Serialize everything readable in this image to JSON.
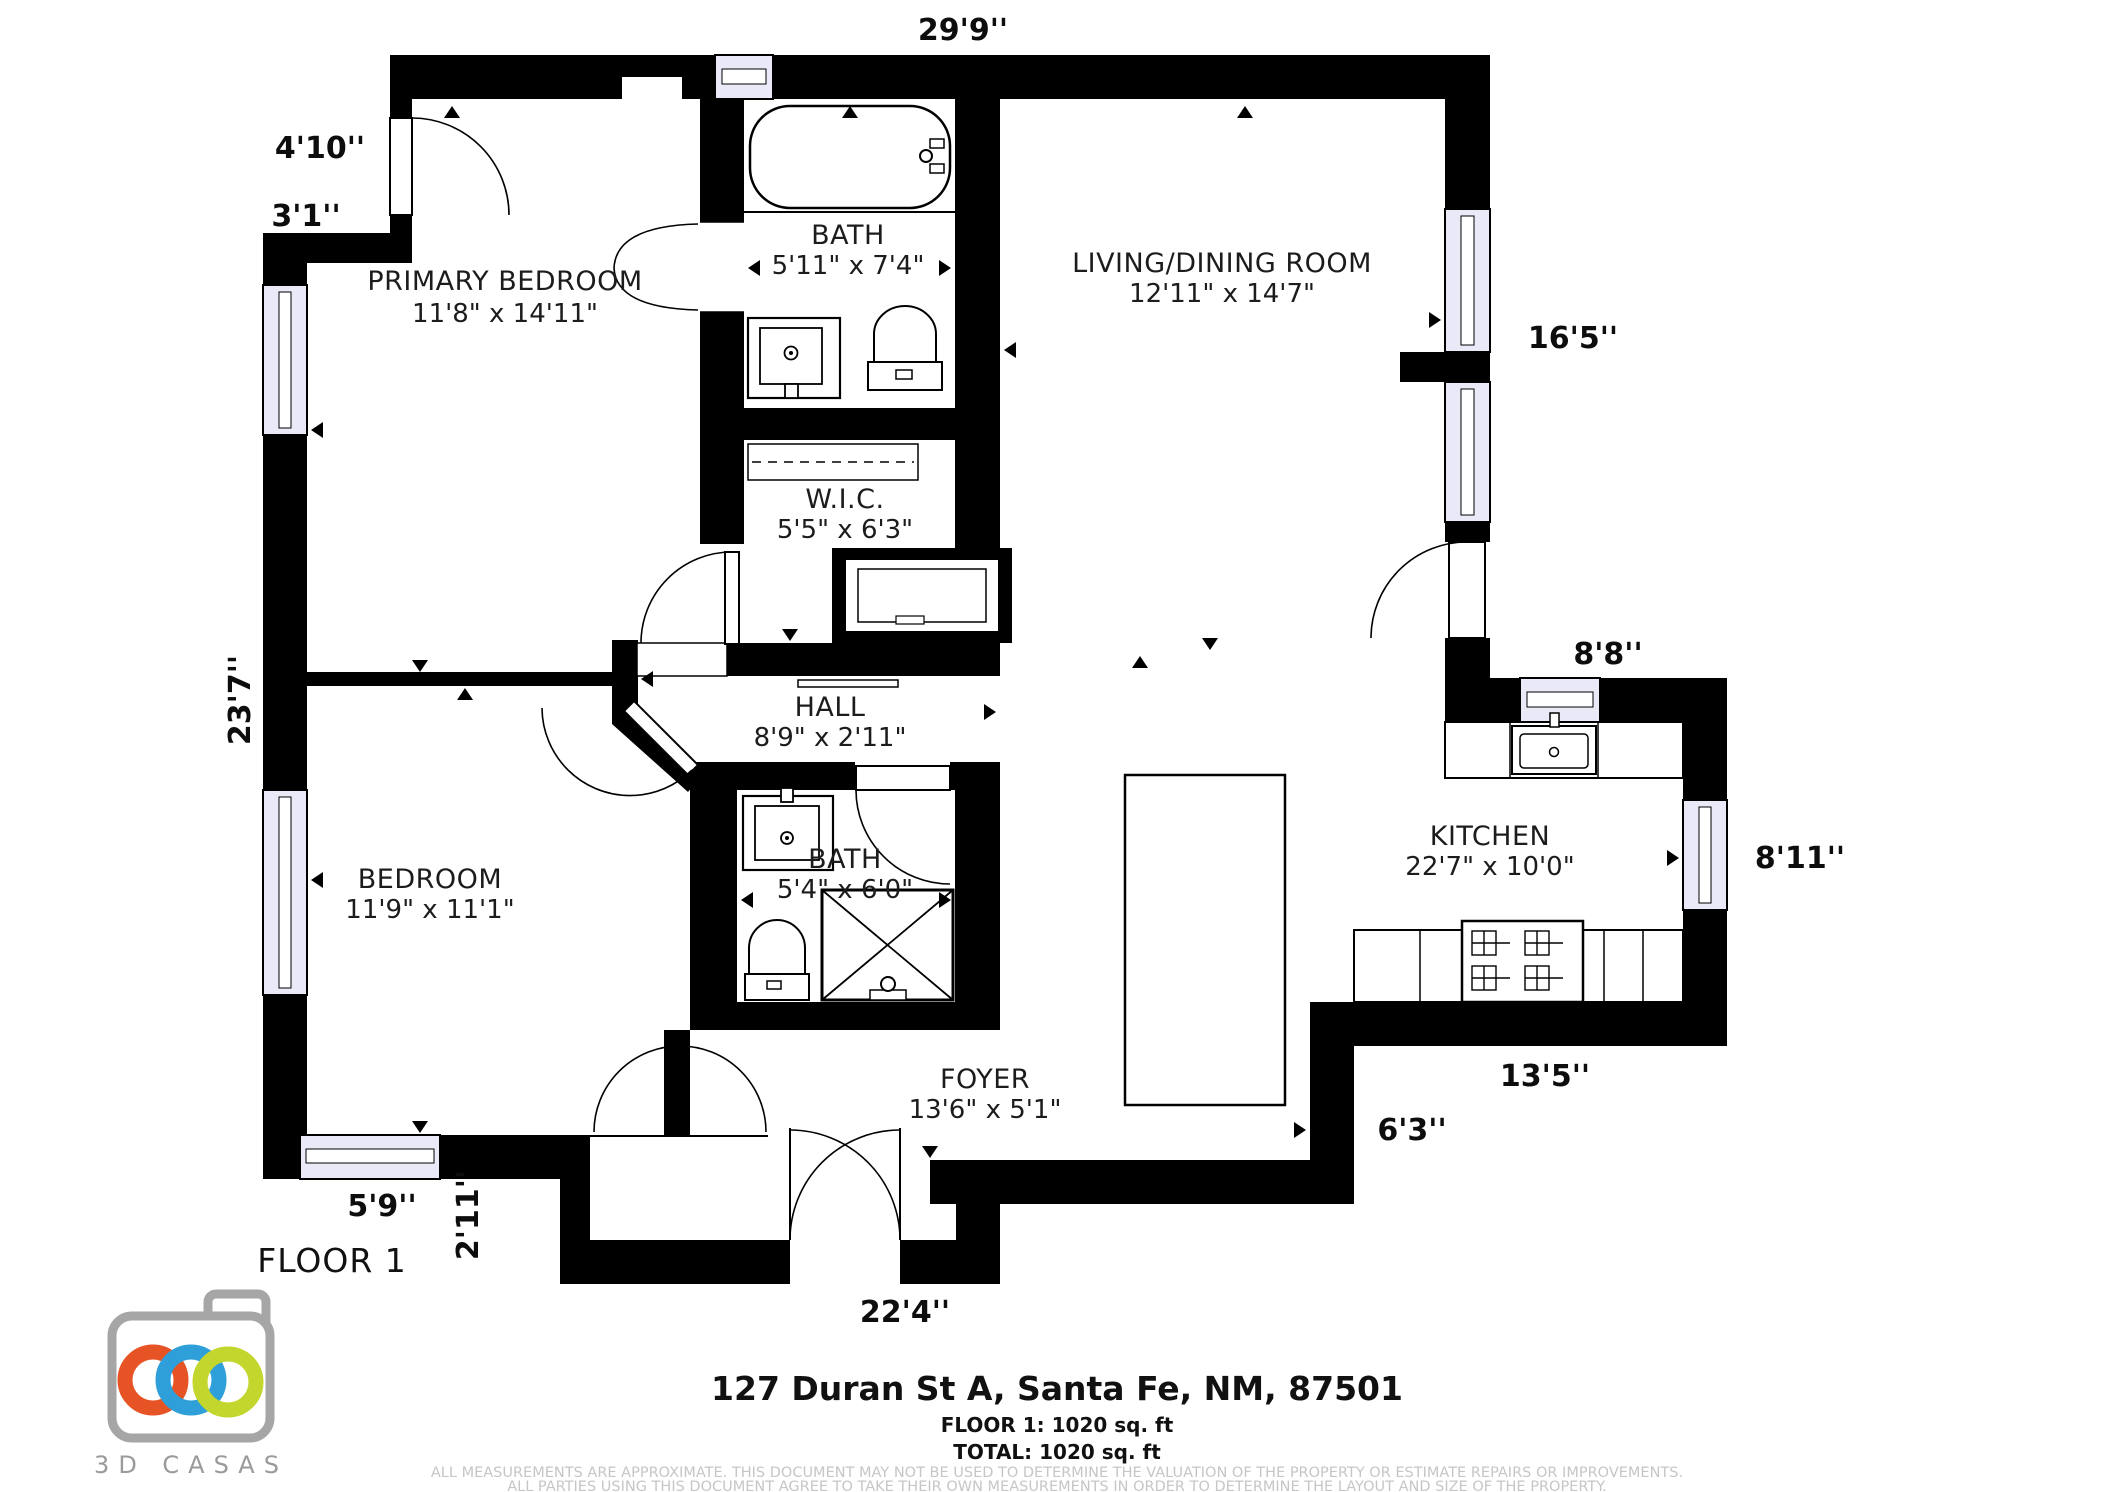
{
  "plan": {
    "floor_label": "FLOOR 1",
    "rooms": {
      "primary_bedroom": {
        "name": "PRIMARY BEDROOM",
        "size": "11'8\" x 14'11\""
      },
      "bath_1": {
        "name": "BATH",
        "size": "5'11\" x 7'4\""
      },
      "wic": {
        "name": "W.I.C.",
        "size": "5'5\" x 6'3\""
      },
      "living_dining": {
        "name": "LIVING/DINING ROOM",
        "size": "12'11\" x 14'7\""
      },
      "hall": {
        "name": "HALL",
        "size": "8'9\" x 2'11\""
      },
      "bedroom": {
        "name": "BEDROOM",
        "size": "11'9\" x 11'1\""
      },
      "bath_2": {
        "name": "BATH",
        "size": "5'4\" x 6'0\""
      },
      "kitchen": {
        "name": "KITCHEN",
        "size": "22'7\" x 10'0\""
      },
      "foyer": {
        "name": "FOYER",
        "size": "13'6\" x 5'1\""
      }
    },
    "dimensions": {
      "top": "29'9''",
      "door_wall": "4'10''",
      "step_wall": "3'1''",
      "left": "23'7''",
      "living_right": "16'5''",
      "kitchen_top": "8'8''",
      "kitchen_right": "8'11''",
      "kitchen_bottom": "13'5''",
      "foyer_right": "6'3''",
      "bedroom_bottom": "5'9''",
      "closet_side": "2'11''",
      "bottom": "22'4''"
    },
    "colors": {
      "wall": "#000000",
      "window": "#e9e9f7"
    }
  },
  "footer": {
    "address": "127 Duran St A, Santa Fe, NM, 87501",
    "floor_area": "FLOOR 1: 1020 sq. ft",
    "total_area": "TOTAL: 1020 sq. ft",
    "disclaimer_1": "ALL MEASUREMENTS ARE APPROXIMATE. THIS DOCUMENT MAY NOT BE USED TO DETERMINE THE VALUATION OF THE PROPERTY OR ESTIMATE REPAIRS OR IMPROVEMENTS.",
    "disclaimer_2": "ALL PARTIES USING THIS DOCUMENT AGREE TO TAKE THEIR OWN MEASUREMENTS IN ORDER TO DETERMINE THE LAYOUT AND SIZE OF THE PROPERTY."
  },
  "logo": {
    "text": "3D CASAS",
    "colors": {
      "orange": "#e65325",
      "blue": "#2e9fd8",
      "yellow": "#c2d62e",
      "camera_gray": "#a6a6a6",
      "text_gray": "#9a9a9a"
    }
  }
}
